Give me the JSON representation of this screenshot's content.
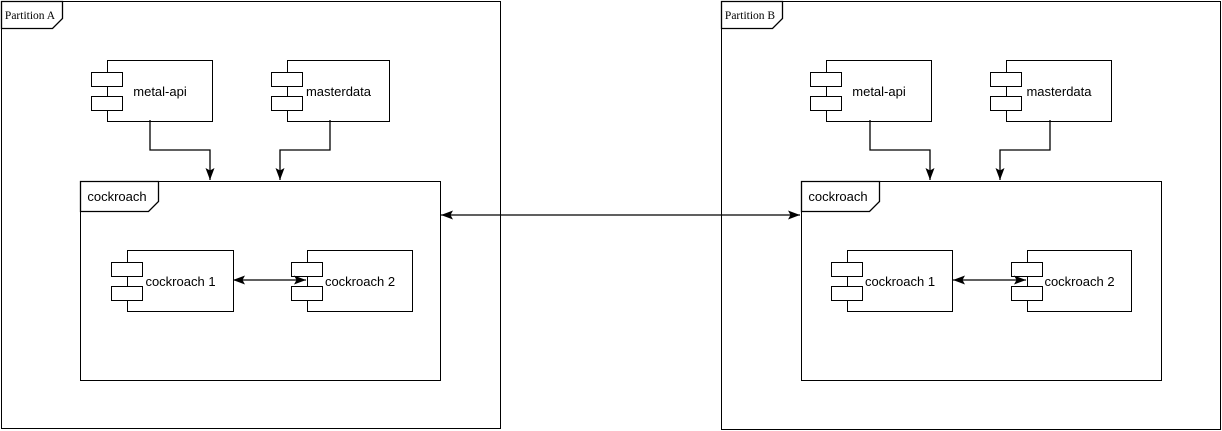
{
  "canvas": {
    "width_px": 1222,
    "height_px": 431,
    "background_color": "#ffffff",
    "stroke_color": "#000000",
    "text_color": "#000000"
  },
  "partitions": [
    {
      "label": "Partition A",
      "components": {
        "metal_api": "metal-api",
        "masterdata": "masterdata"
      },
      "cockroach_container": {
        "label": "cockroach",
        "components": {
          "cockroach_1": "cockroach 1",
          "cockroach_2": "cockroach 2"
        }
      }
    },
    {
      "label": "Partition B",
      "components": {
        "metal_api": "metal-api",
        "masterdata": "masterdata"
      },
      "cockroach_container": {
        "label": "cockroach",
        "components": {
          "cockroach_1": "cockroach 1",
          "cockroach_2": "cockroach 2"
        }
      }
    }
  ],
  "connections": [
    {
      "from": "metal-api (Partition A)",
      "to": "cockroach (Partition A)",
      "style": "single-arrow"
    },
    {
      "from": "masterdata (Partition A)",
      "to": "cockroach (Partition A)",
      "style": "single-arrow"
    },
    {
      "from": "cockroach 1 (Partition A)",
      "to": "cockroach 2 (Partition A)",
      "style": "double-arrow"
    },
    {
      "from": "metal-api (Partition B)",
      "to": "cockroach (Partition B)",
      "style": "single-arrow"
    },
    {
      "from": "masterdata (Partition B)",
      "to": "cockroach (Partition B)",
      "style": "single-arrow"
    },
    {
      "from": "cockroach 1 (Partition B)",
      "to": "cockroach 2 (Partition B)",
      "style": "double-arrow"
    },
    {
      "from": "cockroach (Partition A)",
      "to": "cockroach (Partition B)",
      "style": "double-arrow"
    }
  ],
  "icons": {
    "component_port": "uml-component-port-icon",
    "partition_tab": "uml-frame-tab"
  }
}
